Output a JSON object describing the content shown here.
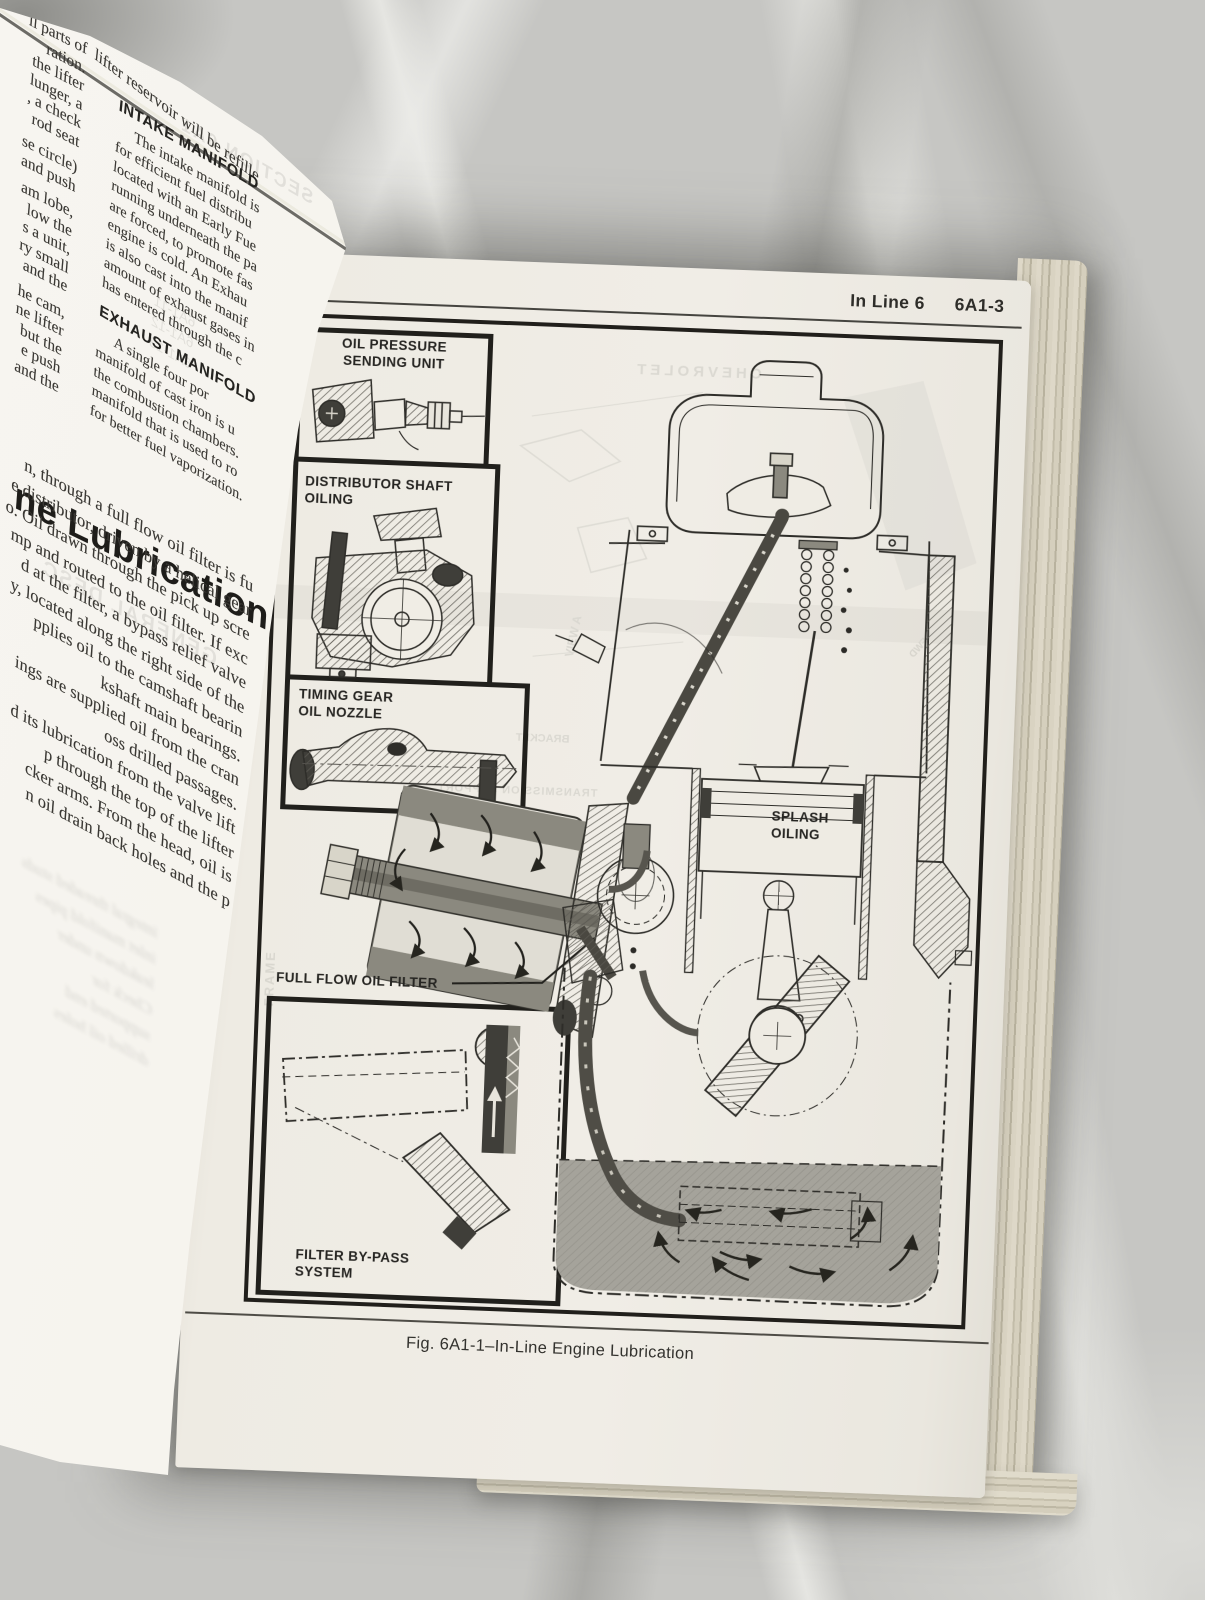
{
  "colors": {
    "marble": "#c6c6c3",
    "page": "#f0ede6",
    "ink": "#2a2926",
    "oil_gray": "#a5a39b"
  },
  "left_page": {
    "curl_line": "lifter reservoir will be refille",
    "col1_fragments": [
      "ll parts of",
      "ration.",
      "the lifter",
      "lunger, a",
      ", a check",
      "rod seat",
      "",
      "se circle)",
      "and push",
      "",
      "am lobe,",
      "low the",
      "s a unit,",
      "ry small",
      "and the",
      "",
      "he cam,",
      "ne lifter",
      "but the",
      "e push",
      "and the"
    ],
    "intake": {
      "heading": "INTAKE MANIFOLD",
      "lines": [
        "     The intake manifold is",
        "for efficient fuel distribu",
        "located with an Early Fue",
        "running underneath the pa",
        "are forced, to promote fas",
        "engine is cold. An Exhau",
        "is also cast into the manif",
        "amount of exhaust gases in",
        "has entered through the c"
      ]
    },
    "exhaust": {
      "heading": "EXHAUST MANIFOLD",
      "lines": [
        "     A single four por",
        "manifold of cast iron is u",
        "the combustion chambers.",
        "manifold that is used to ro",
        "for better fuel vaporization."
      ]
    },
    "lubrication_heading": "ne Lubrication",
    "lube_lines": [
      "n, through a full flow oil filter is fu",
      "e distributor, driven by a helical gear",
      "o. Oil drawn through the pick up scre",
      "mp and routed to the oil filter. If exc",
      "d at the filter, a bypass relief valve",
      "y, located along the right side of the",
      "pplies oil to the camshaft bearin",
      "kshaft main bearings.",
      "ings are supplied oil from the cran",
      "oss drilled passages.",
      "d its lubrication from the valve lift",
      "p through the top of the lifter",
      "cker arms. From the head, oil is",
      "n oil drain back holes and the p"
    ],
    "bleedthrough": {
      "section": "SECTION 6A1",
      "refs": [
        "6A1-11",
        "6A1-12",
        "6A1-13"
      ],
      "general": "GENERAL DESC",
      "blurred": [
        "integral threaded studs",
        "inlet manifold pipes",
        "leakdown under",
        "Check for",
        "supported end",
        "drilled oil holes"
      ]
    }
  },
  "right_page": {
    "header": {
      "section": "In Line 6",
      "page_number": "6A1-3"
    },
    "caption": "Fig. 6A1-1–In-Line Engine Lubrication",
    "figure_labels": {
      "oil_pressure": "OIL PRESSURE\nSENDING UNIT",
      "distributor": "DISTRIBUTOR SHAFT\nOILING",
      "timing_gear": "TIMING GEAR\nOIL NOZZLE",
      "oil_filter": "FULL FLOW OIL FILTER",
      "bypass": "FILTER BY-PASS\nSYSTEM",
      "splash": "SPLASH\nOILING"
    },
    "bleedthrough": {
      "chevrolet": "CHEVROLET",
      "frame": "FRAME",
      "view_a": "VIEW A",
      "trans_support": "TRANSMISSION SUPPORT",
      "bracket": "BRACKET",
      "fwd": "FWD"
    }
  }
}
